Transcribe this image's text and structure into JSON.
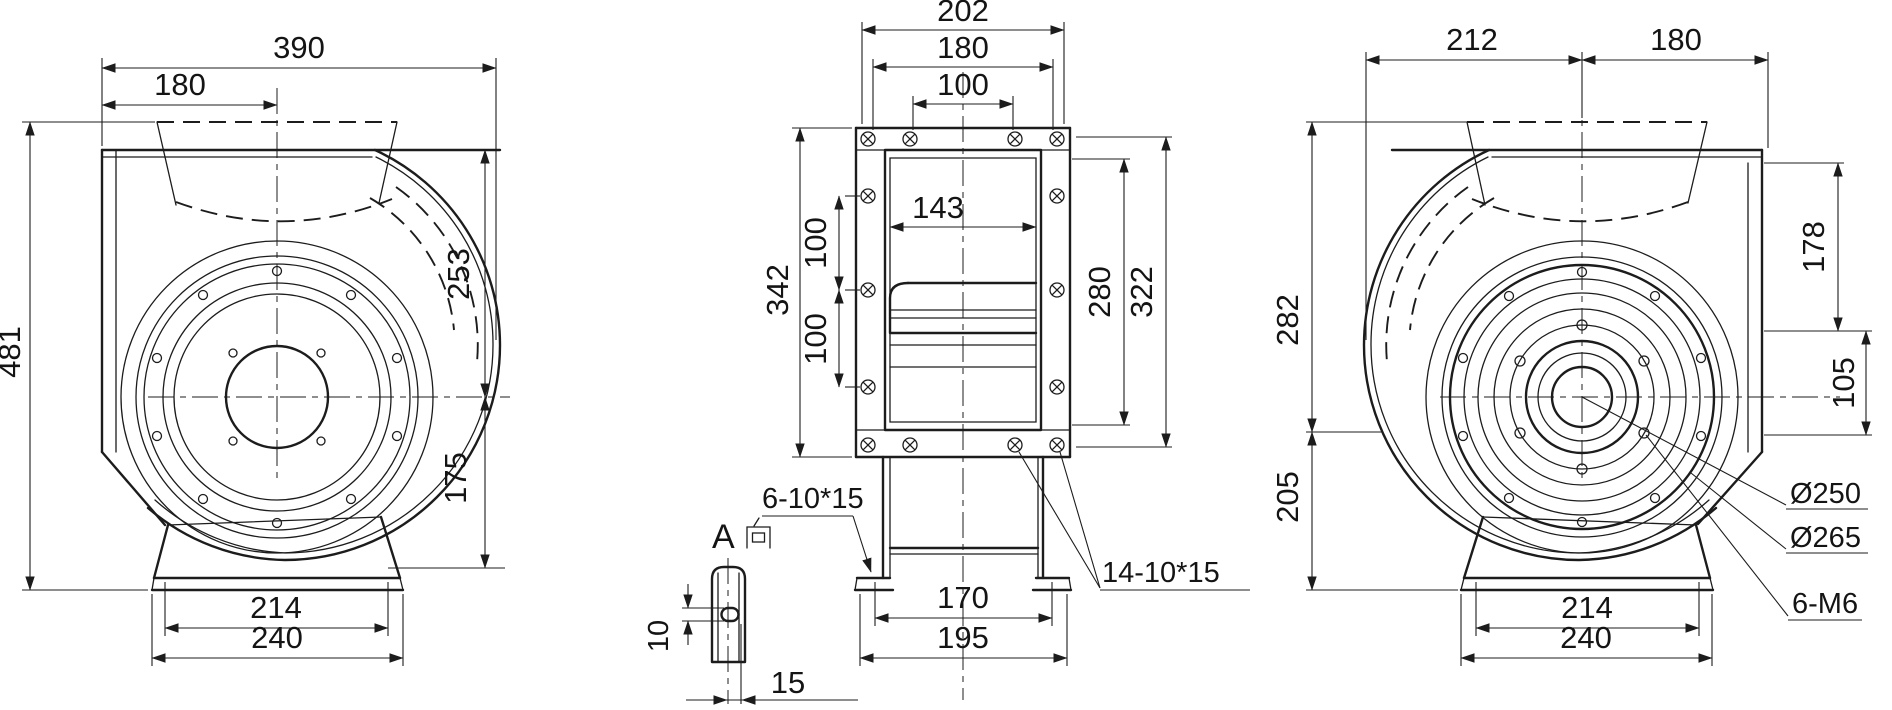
{
  "meta": {
    "type": "engineering-dimension-drawing",
    "subject": "centrifugal-fan-three-views",
    "background": "#ffffff",
    "line_color": "#1c1c1c"
  },
  "views": {
    "side_view_left": {
      "name": "left-side-view",
      "dims": {
        "overall_width": "390",
        "center_offset": "180",
        "overall_height": "481",
        "top_to_axis": "253",
        "axis_to_bottom": "175",
        "base_top": "214",
        "base_bottom": "240"
      }
    },
    "front_view": {
      "name": "front-view",
      "dims": {
        "outlet_flange_width": "202",
        "outlet_bolt_span": "180",
        "outlet_bolt_pitch": "100",
        "overall_height": "342",
        "side_bolt_pitch_upper": "100",
        "side_bolt_pitch_lower": "100",
        "housing_width": "143",
        "side_bolt_span": "280",
        "flange_span": "322",
        "foot_slot_span": "170",
        "foot_width": "195"
      },
      "notes": {
        "foot_slots": "6-10*15",
        "flange_slots": "14-10*15"
      }
    },
    "detail_a": {
      "label": "A向",
      "letter": "A",
      "dims": {
        "slot_height": "10",
        "slot_width": "15"
      }
    },
    "side_view_right": {
      "name": "right-side-view",
      "dims": {
        "axis_to_left": "212",
        "axis_to_right": "180",
        "top_to_axis": "282",
        "inlet_height": "178",
        "step_height": "105",
        "axis_to_base": "205",
        "base_top": "214",
        "base_bottom": "240"
      },
      "notes": {
        "bolt_circle_dia": "Ø250",
        "ring_dia": "Ø265",
        "bolt_spec": "6-M6"
      }
    }
  }
}
